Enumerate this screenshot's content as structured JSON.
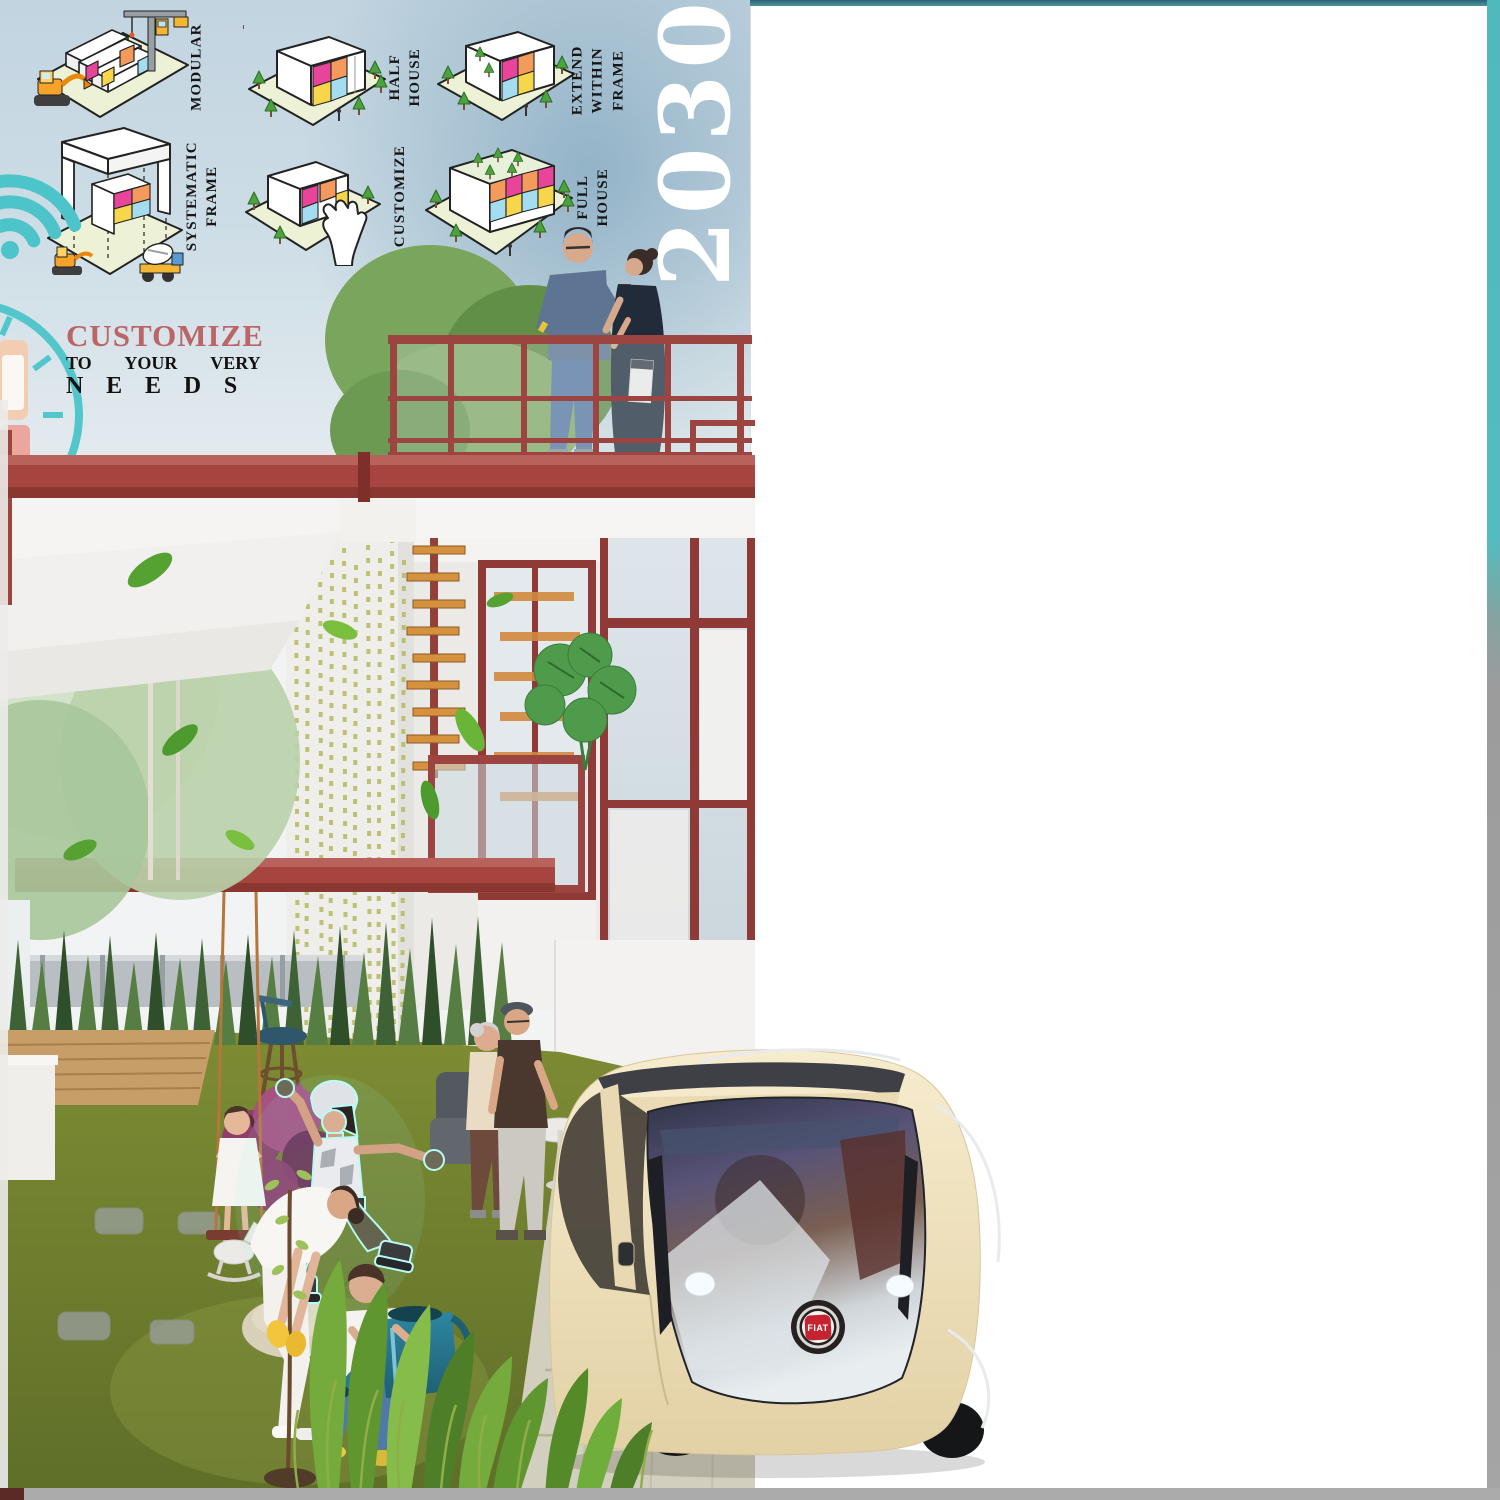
{
  "header": {
    "diagrams": [
      {
        "id": "modular",
        "label": "MODULAR"
      },
      {
        "id": "half-house",
        "label": "HALF\nHOUSE"
      },
      {
        "id": "extend-within-frame",
        "label": "EXTEND\nWITHIN\nFRAME"
      },
      {
        "id": "systematic-frame",
        "label": "SYSTEMATIC\nFRAME"
      },
      {
        "id": "customize",
        "label": "CUSTOMIZE"
      },
      {
        "id": "full-house",
        "label": "FULL\nHOUSE"
      }
    ],
    "year": "2030"
  },
  "tagline": {
    "title": "CUSTOMIZE",
    "subtitle": "TO YOUR VERY",
    "emphasis": "NEEDS"
  },
  "scene": {
    "car_badge": "FIAT"
  },
  "colors": {
    "teal_accent": "#4cc4ca",
    "teal_border_top": "#2f6f7e",
    "steel_red": "#a6453f",
    "tagline_red": "#bc6566",
    "panel_pink": "#e8459a",
    "panel_orange": "#f59a5d",
    "panel_yellow": "#f7d64b",
    "panel_blue": "#a5ddf0",
    "diagram_ground": "#edf2d7",
    "grass_green": "#76852f",
    "car_cream": "#ede0bd",
    "sky_blue": "#c2d4e0"
  }
}
